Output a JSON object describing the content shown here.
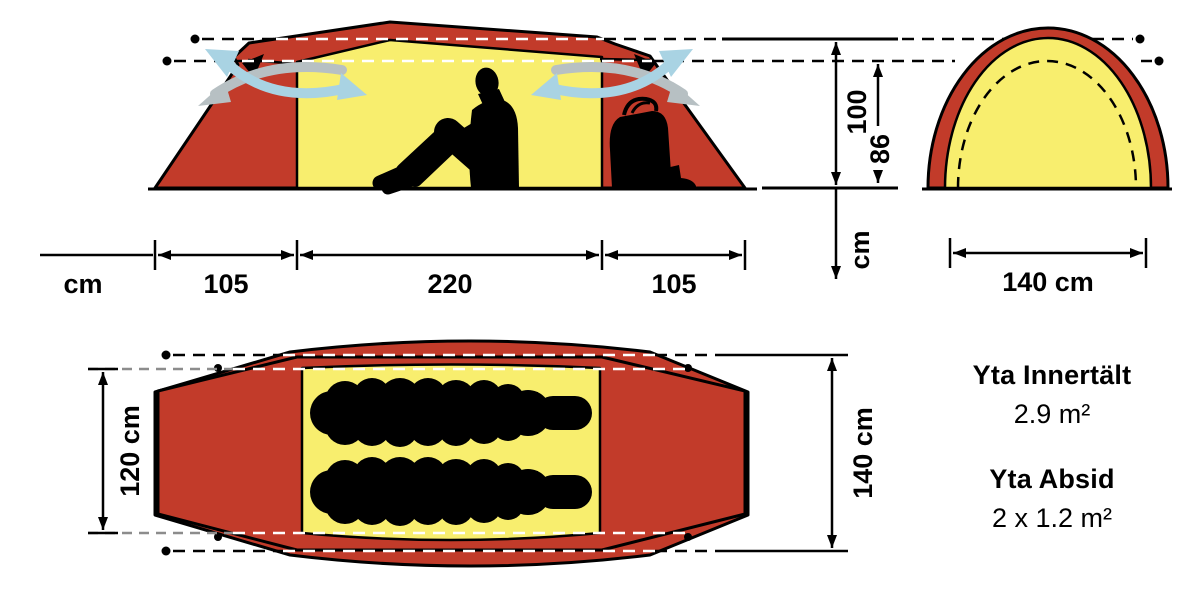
{
  "colors": {
    "fly_red": "#c23b2a",
    "inner_yellow": "#f8ee6e",
    "vent_blue": "#a9d3e3",
    "vent_gray": "#b7c0c3",
    "dash_gray": "#8c8c8c"
  },
  "side_view": {
    "width_unit_label": "cm",
    "widths": [
      "105",
      "220",
      "105"
    ],
    "height_outer": "100",
    "height_inner": "86",
    "height_unit_label": "cm"
  },
  "end_view": {
    "width_label": "140 cm"
  },
  "top_view": {
    "inner_width_label": "120 cm",
    "outer_width_label": "140 cm"
  },
  "areas": {
    "inner_tent_label": "Yta Innertält",
    "inner_tent_value": "2.9 m²",
    "vestibule_label": "Yta Absid",
    "vestibule_value": "2 x 1.2 m²"
  }
}
